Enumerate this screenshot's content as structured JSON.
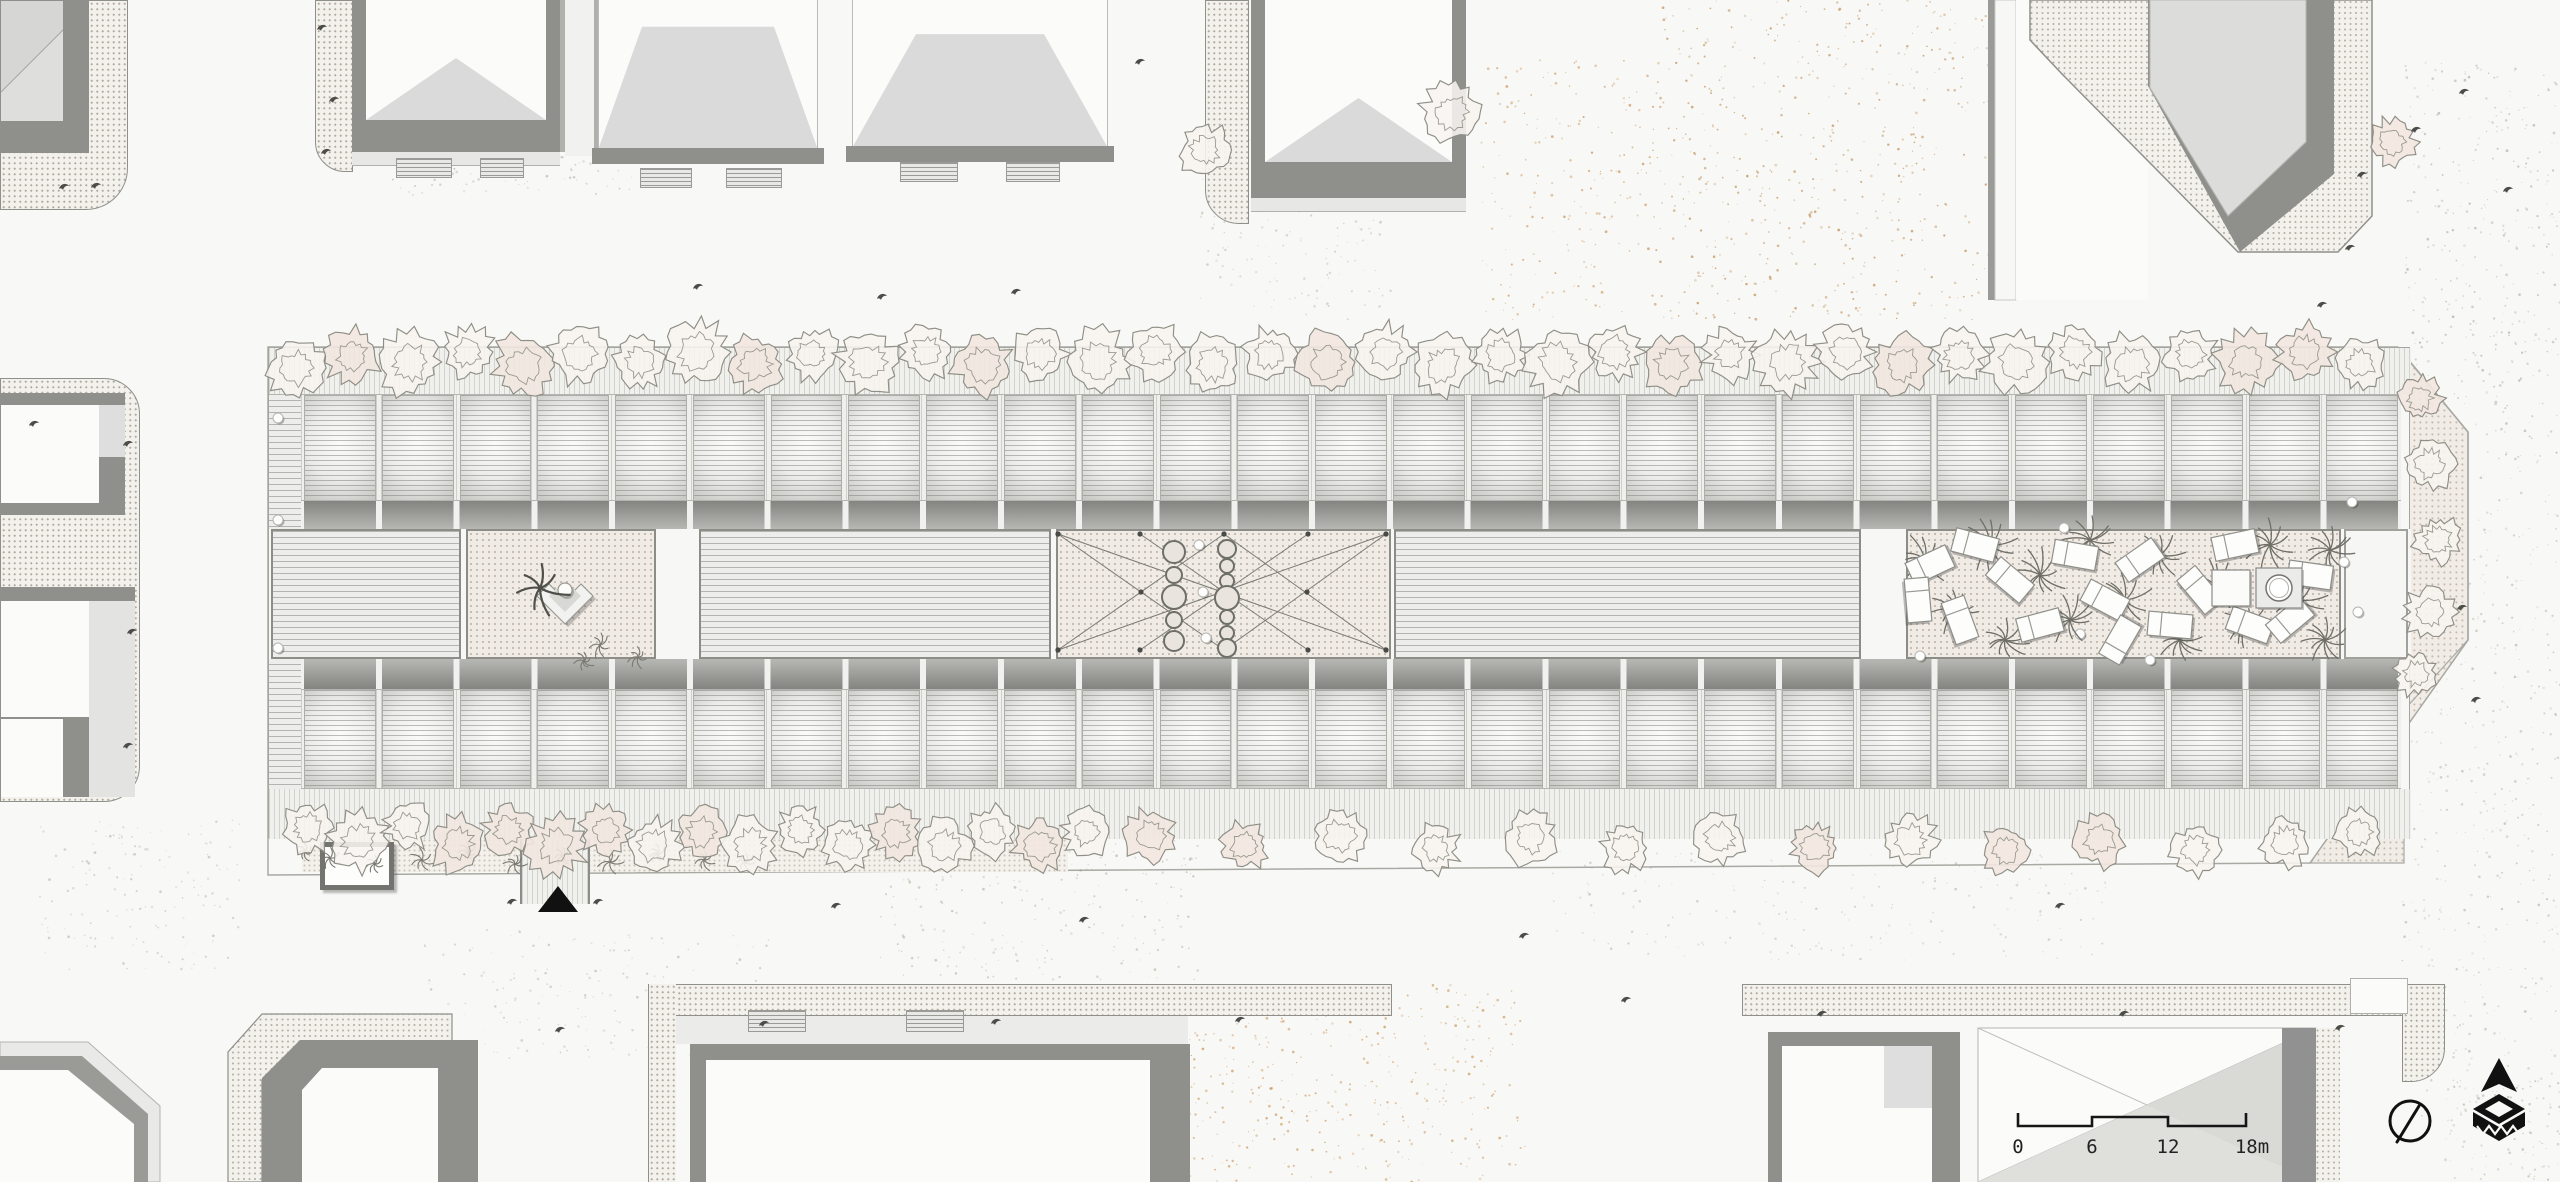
{
  "scalebar": {
    "labels": [
      "0",
      "6",
      "12",
      "18m"
    ],
    "label_x": [
      2018,
      2092,
      2168,
      2252
    ],
    "bar_path": "M2018,1113 L2018,1126 L2092,1126 L2092,1117 L2168,1117 L2168,1126 L2246,1126 L2246,1113"
  },
  "icons": {
    "north_arrow": "north-arrow-icon",
    "logo": "publisher-logo-icon"
  },
  "palette": {
    "paper": "#f8f8f6",
    "roof_light": "#dadada",
    "band_dark": "#8f8f8b",
    "ink": "#161616",
    "sand": "#cf9f66",
    "court_ground": "#f1ebe6",
    "tree_stroke": "#8e8e85",
    "plant_stroke": "#6f6f68"
  },
  "building": {
    "modules_per_row": 27,
    "segments": [
      {
        "name": "flat-roof-block-west",
        "type": "hlines",
        "x": 2,
        "w": 190
      },
      {
        "name": "courtyard-west",
        "type": "cdots",
        "x": 197,
        "w": 190
      },
      {
        "name": "flat-roof-block-mid-west",
        "type": "hlines",
        "x": 430,
        "w": 352
      },
      {
        "name": "central-plaza",
        "type": "cdots",
        "x": 787,
        "w": 335
      },
      {
        "name": "flat-roof-block-mid-east",
        "type": "hlines",
        "x": 1125,
        "w": 467
      },
      {
        "name": "palm-garden",
        "type": "cdots",
        "x": 1637,
        "w": 435
      },
      {
        "name": "end-block-east",
        "type": "white",
        "x": 2075,
        "w": 64
      }
    ]
  },
  "trees": {
    "top": [
      [
        296,
        368,
        30
      ],
      [
        352,
        356,
        28
      ],
      [
        410,
        362,
        34
      ],
      [
        468,
        352,
        26
      ],
      [
        524,
        366,
        32
      ],
      [
        580,
        354,
        30
      ],
      [
        640,
        362,
        27
      ],
      [
        697,
        352,
        33
      ],
      [
        755,
        364,
        29
      ],
      [
        812,
        354,
        26
      ],
      [
        868,
        362,
        32
      ],
      [
        926,
        352,
        28
      ],
      [
        983,
        365,
        30
      ],
      [
        1040,
        354,
        27
      ],
      [
        1098,
        362,
        33
      ],
      [
        1155,
        352,
        28
      ],
      [
        1213,
        364,
        30
      ],
      [
        1270,
        354,
        26
      ],
      [
        1328,
        362,
        32
      ],
      [
        1385,
        352,
        28
      ],
      [
        1443,
        365,
        30
      ],
      [
        1500,
        355,
        27
      ],
      [
        1558,
        362,
        33
      ],
      [
        1615,
        352,
        28
      ],
      [
        1672,
        364,
        30
      ],
      [
        1730,
        355,
        26
      ],
      [
        1787,
        362,
        32
      ],
      [
        1845,
        352,
        28
      ],
      [
        1902,
        365,
        30
      ],
      [
        1960,
        355,
        27
      ],
      [
        2017,
        362,
        33
      ],
      [
        2075,
        352,
        28
      ],
      [
        2132,
        364,
        30
      ],
      [
        2190,
        355,
        26
      ],
      [
        2247,
        362,
        31
      ],
      [
        2305,
        352,
        28
      ],
      [
        2360,
        364,
        26
      ]
    ],
    "bottom": [
      [
        308,
        828,
        26
      ],
      [
        358,
        842,
        30
      ],
      [
        408,
        826,
        24
      ],
      [
        458,
        844,
        28
      ],
      [
        508,
        830,
        26
      ],
      [
        556,
        846,
        30
      ],
      [
        606,
        830,
        25
      ],
      [
        654,
        846,
        28
      ],
      [
        702,
        832,
        26
      ],
      [
        750,
        846,
        29
      ],
      [
        800,
        830,
        24
      ],
      [
        848,
        845,
        27
      ],
      [
        896,
        832,
        26
      ],
      [
        944,
        846,
        28
      ],
      [
        992,
        832,
        25
      ],
      [
        1040,
        845,
        27
      ],
      [
        1086,
        832,
        24
      ],
      [
        1150,
        836,
        26
      ],
      [
        1245,
        846,
        24
      ],
      [
        1340,
        836,
        28
      ],
      [
        1435,
        848,
        24
      ],
      [
        1530,
        838,
        27
      ],
      [
        1625,
        848,
        24
      ],
      [
        1720,
        838,
        27
      ],
      [
        1815,
        848,
        25
      ],
      [
        1910,
        840,
        27
      ],
      [
        2005,
        850,
        24
      ],
      [
        2100,
        840,
        27
      ],
      [
        2195,
        850,
        25
      ],
      [
        2285,
        842,
        26
      ],
      [
        2358,
        832,
        24
      ]
    ],
    "right": [
      [
        2420,
        398,
        22
      ],
      [
        2430,
        464,
        26
      ],
      [
        2438,
        540,
        24
      ],
      [
        2430,
        612,
        26
      ],
      [
        2416,
        674,
        22
      ]
    ],
    "standalone": [
      [
        1205,
        150,
        26
      ],
      [
        1452,
        112,
        30
      ],
      [
        2392,
        142,
        24
      ]
    ]
  },
  "palms": [
    [
      1925,
      560,
      24
    ],
    [
      1955,
      610,
      22
    ],
    [
      1990,
      545,
      25
    ],
    [
      2005,
      640,
      21
    ],
    [
      2040,
      575,
      24
    ],
    [
      2070,
      620,
      22
    ],
    [
      2090,
      540,
      23
    ],
    [
      2125,
      600,
      26
    ],
    [
      2160,
      555,
      22
    ],
    [
      2180,
      640,
      22
    ],
    [
      2215,
      585,
      25
    ],
    [
      2245,
      625,
      21
    ],
    [
      2270,
      545,
      23
    ],
    [
      2300,
      600,
      24
    ],
    [
      2325,
      640,
      20
    ],
    [
      2330,
      550,
      21
    ]
  ],
  "shrubs": [
    [
      600,
      645,
      12
    ],
    [
      638,
      657,
      10
    ],
    [
      584,
      661,
      9
    ],
    [
      330,
      858,
      11
    ],
    [
      375,
      864,
      9
    ],
    [
      422,
      860,
      12
    ],
    [
      468,
      852,
      9
    ],
    [
      515,
      864,
      11
    ],
    [
      562,
      856,
      9
    ],
    [
      610,
      862,
      12
    ],
    [
      658,
      854,
      9
    ],
    [
      704,
      860,
      11
    ],
    [
      305,
      852,
      8
    ],
    [
      745,
      862,
      9
    ]
  ],
  "star_plant": [
    540,
    588,
    27
  ],
  "bench": {
    "outer": "M537,596 L565,624 L593,596 L581,584 L565,600 L549,584 Z",
    "inner": "M549,596 L565,612 L581,596 L573,588 L565,596 L557,588 Z",
    "circle": [
      565,
      590,
      7
    ]
  },
  "chairs": [
    [
      1930,
      565,
      -25
    ],
    [
      1975,
      545,
      15
    ],
    [
      2010,
      580,
      40
    ],
    [
      1960,
      620,
      70
    ],
    [
      2040,
      625,
      -15
    ],
    [
      2075,
      555,
      10
    ],
    [
      2105,
      600,
      28
    ],
    [
      2140,
      560,
      -35
    ],
    [
      2170,
      625,
      5
    ],
    [
      2200,
      590,
      50
    ],
    [
      2235,
      545,
      -12
    ],
    [
      2250,
      625,
      20
    ],
    [
      2290,
      620,
      -40
    ],
    [
      2310,
      575,
      8
    ],
    [
      2120,
      640,
      -60
    ],
    [
      1918,
      600,
      85
    ]
  ],
  "garden": {
    "table": [
      2212,
      570,
      38,
      36
    ],
    "jacuzzi": [
      2256,
      568,
      46,
      40
    ],
    "jacuzzi_circle": [
      2279,
      588,
      13
    ]
  },
  "plaza": {
    "lines": [
      [
        1058,
        534,
        1386,
        650
      ],
      [
        1058,
        650,
        1386,
        534
      ],
      [
        1058,
        534,
        1224,
        650
      ],
      [
        1224,
        534,
        1058,
        650
      ],
      [
        1224,
        534,
        1386,
        650
      ],
      [
        1386,
        534,
        1224,
        650
      ],
      [
        1140,
        534,
        1308,
        650
      ],
      [
        1308,
        534,
        1140,
        650
      ]
    ],
    "extra_nodes": [
      [
        1224,
        592
      ],
      [
        1141,
        592
      ],
      [
        1307,
        592
      ]
    ],
    "circles": [
      [
        1174,
        552,
        11
      ],
      [
        1174,
        575,
        8
      ],
      [
        1174,
        597,
        12
      ],
      [
        1174,
        620,
        8
      ],
      [
        1174,
        641,
        10
      ],
      [
        1227,
        549,
        9
      ],
      [
        1227,
        566,
        7
      ],
      [
        1227,
        581,
        7
      ],
      [
        1227,
        598,
        12
      ],
      [
        1227,
        617,
        7
      ],
      [
        1227,
        633,
        7
      ],
      [
        1227,
        648,
        9
      ]
    ],
    "white_posts": [
      [
        1199,
        545
      ],
      [
        1203,
        592
      ],
      [
        1206,
        638
      ]
    ]
  },
  "posts": [
    [
      278,
      418
    ],
    [
      278,
      520
    ],
    [
      278,
      648
    ],
    [
      1920,
      656
    ],
    [
      2064,
      528
    ],
    [
      2080,
      634
    ],
    [
      2150,
      660
    ],
    [
      2344,
      562
    ],
    [
      2358,
      612
    ],
    [
      2352,
      502
    ]
  ],
  "birds": [
    [
      322,
      28
    ],
    [
      334,
      100
    ],
    [
      326,
      152
    ],
    [
      64,
      187
    ],
    [
      96,
      186
    ],
    [
      698,
      287
    ],
    [
      882,
      297
    ],
    [
      1016,
      292
    ],
    [
      1140,
      62
    ],
    [
      2362,
      175
    ],
    [
      2416,
      130
    ],
    [
      2350,
      248
    ],
    [
      2322,
      305
    ],
    [
      2464,
      92
    ],
    [
      2508,
      190
    ],
    [
      2462,
      608
    ],
    [
      2476,
      700
    ],
    [
      34,
      424
    ],
    [
      128,
      444
    ],
    [
      132,
      632
    ],
    [
      128,
      746
    ],
    [
      560,
      1030
    ],
    [
      764,
      1024
    ],
    [
      996,
      1022
    ],
    [
      1240,
      1020
    ],
    [
      1626,
      1000
    ],
    [
      1822,
      1014
    ],
    [
      2124,
      1014
    ],
    [
      2340,
      1028
    ],
    [
      1084,
      920
    ],
    [
      1524,
      936
    ],
    [
      836,
      906
    ],
    [
      2060,
      906
    ],
    [
      512,
      902
    ],
    [
      598,
      902
    ]
  ],
  "entrance_triangle": "538,912 578,912 558,886",
  "north_icon": {
    "cx": 2410,
    "cy": 1121,
    "r": 20,
    "needle": [
      2419,
      1106,
      2397,
      1142
    ]
  },
  "logo": {
    "arrow": "2499,1058 2481,1092 2499,1084 2517,1092",
    "diamond": "2499,1094 2525,1109 2499,1124 2473,1109",
    "diamond_hole": "2499,1101 2513,1109 2499,1117 2485,1109",
    "body": "2473,1112 2499,1127 2525,1112 2525,1126 2499,1141 2473,1126",
    "zigzag": "M2477,1126 L2483,1134 L2489,1126 L2495,1134 L2501,1126 L2507,1134 L2513,1126 L2519,1134"
  },
  "speckles": [
    {
      "x": 1660,
      "y": 0,
      "w": 330,
      "h": 320,
      "n": 520,
      "c": "#c59a67"
    },
    {
      "x": 2405,
      "y": 60,
      "w": 155,
      "h": 420,
      "n": 380,
      "c": "#b9b9b0"
    },
    {
      "x": 2400,
      "y": 480,
      "w": 160,
      "h": 640,
      "n": 460,
      "c": "#c2c2ba"
    },
    {
      "x": 390,
      "y": 10,
      "w": 250,
      "h": 185,
      "n": 300,
      "c": "#bcbcb4"
    },
    {
      "x": 1145,
      "y": 985,
      "w": 380,
      "h": 197,
      "n": 400,
      "c": "#cf9f66"
    },
    {
      "x": 880,
      "y": 830,
      "w": 320,
      "h": 150,
      "n": 240,
      "c": "#c7bfb2"
    },
    {
      "x": 1480,
      "y": 60,
      "w": 180,
      "h": 260,
      "n": 200,
      "c": "#cf9f66"
    },
    {
      "x": 420,
      "y": 930,
      "w": 350,
      "h": 130,
      "n": 180,
      "c": "#c5c5bd"
    },
    {
      "x": 1550,
      "y": 850,
      "w": 560,
      "h": 110,
      "n": 200,
      "c": "#c6c6be"
    },
    {
      "x": 40,
      "y": 820,
      "w": 200,
      "h": 150,
      "n": 150,
      "c": "#c3c3bb"
    },
    {
      "x": 2445,
      "y": 1080,
      "w": 115,
      "h": 100,
      "n": 110,
      "c": "#c2c2ba"
    },
    {
      "x": 1200,
      "y": 120,
      "w": 200,
      "h": 200,
      "n": 180,
      "c": "#c9c9c0"
    }
  ]
}
